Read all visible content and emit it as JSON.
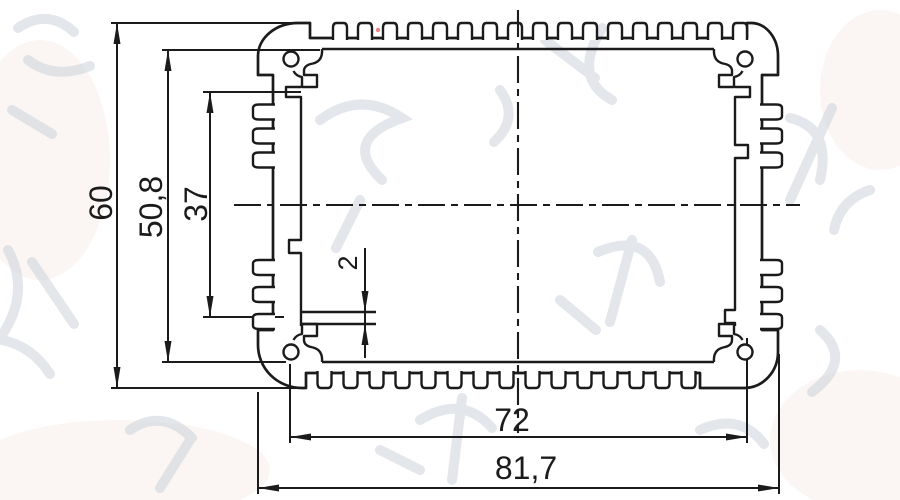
{
  "drawing": {
    "kind": "aluminum extrusion enclosure profile cross-section",
    "dims": {
      "overall_height": "60",
      "inner_height": "50,8",
      "fin_zone_height": "37",
      "slot_width": "2",
      "inner_width": "72",
      "overall_width": "81,7"
    },
    "watermark_text": "鸿发顺达",
    "colors": {
      "line": "#1b1b1b",
      "background": "#ffffff",
      "watermark": "#ccd1da",
      "red_mark": "#e06666"
    }
  }
}
